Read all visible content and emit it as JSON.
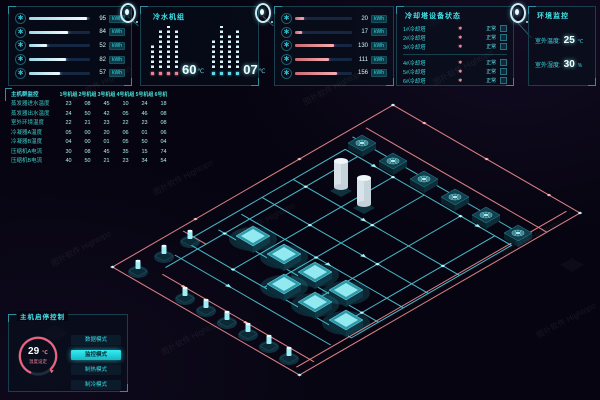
{
  "watermark": "图扑软件 Hightopo",
  "colors": {
    "cyan_accent": "#35dde6",
    "salmon_pipe": "#ef8d8e",
    "cyan_pipe": "#55d4e4",
    "white_bar": "#eefcff",
    "pink_bar": "#f7aeb0",
    "active_button": "#27e7ee"
  },
  "panels": {
    "energy_a": {
      "rows": [
        {
          "value": "95",
          "unit": "kWh",
          "pct": 95
        },
        {
          "value": "84",
          "unit": "kWh",
          "pct": 64
        },
        {
          "value": "52",
          "unit": "kWh",
          "pct": 29
        },
        {
          "value": "82",
          "unit": "kWh",
          "pct": 61
        },
        {
          "value": "57",
          "unit": "kWh",
          "pct": 51
        }
      ]
    },
    "chiller": {
      "title": "冷水机组",
      "groups": [
        {
          "color": "pink",
          "bars": [
            24,
            38,
            42,
            38
          ],
          "readout": "60",
          "unit": "℃"
        },
        {
          "color": "cyan",
          "bars": [
            30,
            42,
            34,
            40
          ],
          "readout": "07",
          "unit": "℃"
        }
      ]
    },
    "energy_b": {
      "rows": [
        {
          "value": "20",
          "unit": "kWh",
          "pct": 15
        },
        {
          "value": "17",
          "unit": "kWh",
          "pct": 12
        },
        {
          "value": "130",
          "unit": "kWh",
          "pct": 69
        },
        {
          "value": "111",
          "unit": "kWh",
          "pct": 59
        },
        {
          "value": "156",
          "unit": "kWh",
          "pct": 73
        }
      ]
    },
    "towers": {
      "title": "冷却塔设备状态",
      "rows": [
        {
          "label": "1#冷却塔",
          "status": "正常"
        },
        {
          "label": "2#冷却塔",
          "status": "正常"
        },
        {
          "label": "3#冷却塔",
          "status": "正常"
        },
        {
          "label": "4#冷却塔",
          "status": "正常"
        },
        {
          "label": "5#冷却塔",
          "status": "正常"
        },
        {
          "label": "6#冷却塔",
          "status": "正常"
        }
      ]
    },
    "env": {
      "title": "环境监控",
      "rows": [
        {
          "label": "室外温度:",
          "value": "25",
          "unit": "℃"
        },
        {
          "label": "室外湿度:",
          "value": "30",
          "unit": "%"
        }
      ]
    }
  },
  "table": {
    "title": "主机群监控",
    "columns": [
      "1号机组",
      "2号机组",
      "3号机组",
      "4号机组",
      "5号机组",
      "6号机组"
    ],
    "rows": [
      {
        "label": "蒸发器进水温度",
        "values": [
          "23",
          "08",
          "45",
          "10",
          "24",
          "18"
        ]
      },
      {
        "label": "蒸发器出水温度",
        "values": [
          "24",
          "50",
          "42",
          "05",
          "46",
          "08"
        ]
      },
      {
        "label": "室外环境温度",
        "values": [
          "22",
          "21",
          "23",
          "22",
          "23",
          "08"
        ]
      },
      {
        "label": "冷凝器A温度",
        "values": [
          "05",
          "00",
          "20",
          "06",
          "01",
          "06"
        ]
      },
      {
        "label": "冷凝器B温度",
        "values": [
          "04",
          "00",
          "01",
          "05",
          "50",
          "04"
        ]
      },
      {
        "label": "压缩机A电流",
        "values": [
          "30",
          "08",
          "45",
          "35",
          "15",
          "74"
        ]
      },
      {
        "label": "压缩机B电流",
        "values": [
          "40",
          "50",
          "21",
          "23",
          "34",
          "54"
        ]
      }
    ]
  },
  "control": {
    "title": "主机启停控制",
    "gauge": {
      "value": "29",
      "unit": "℃",
      "label": "温度设定"
    },
    "buttons": [
      {
        "label": "数据模式",
        "active": false
      },
      {
        "label": "监控模式",
        "active": true
      },
      {
        "label": "制热模式",
        "active": false
      },
      {
        "label": "制冷模式",
        "active": false
      }
    ]
  }
}
